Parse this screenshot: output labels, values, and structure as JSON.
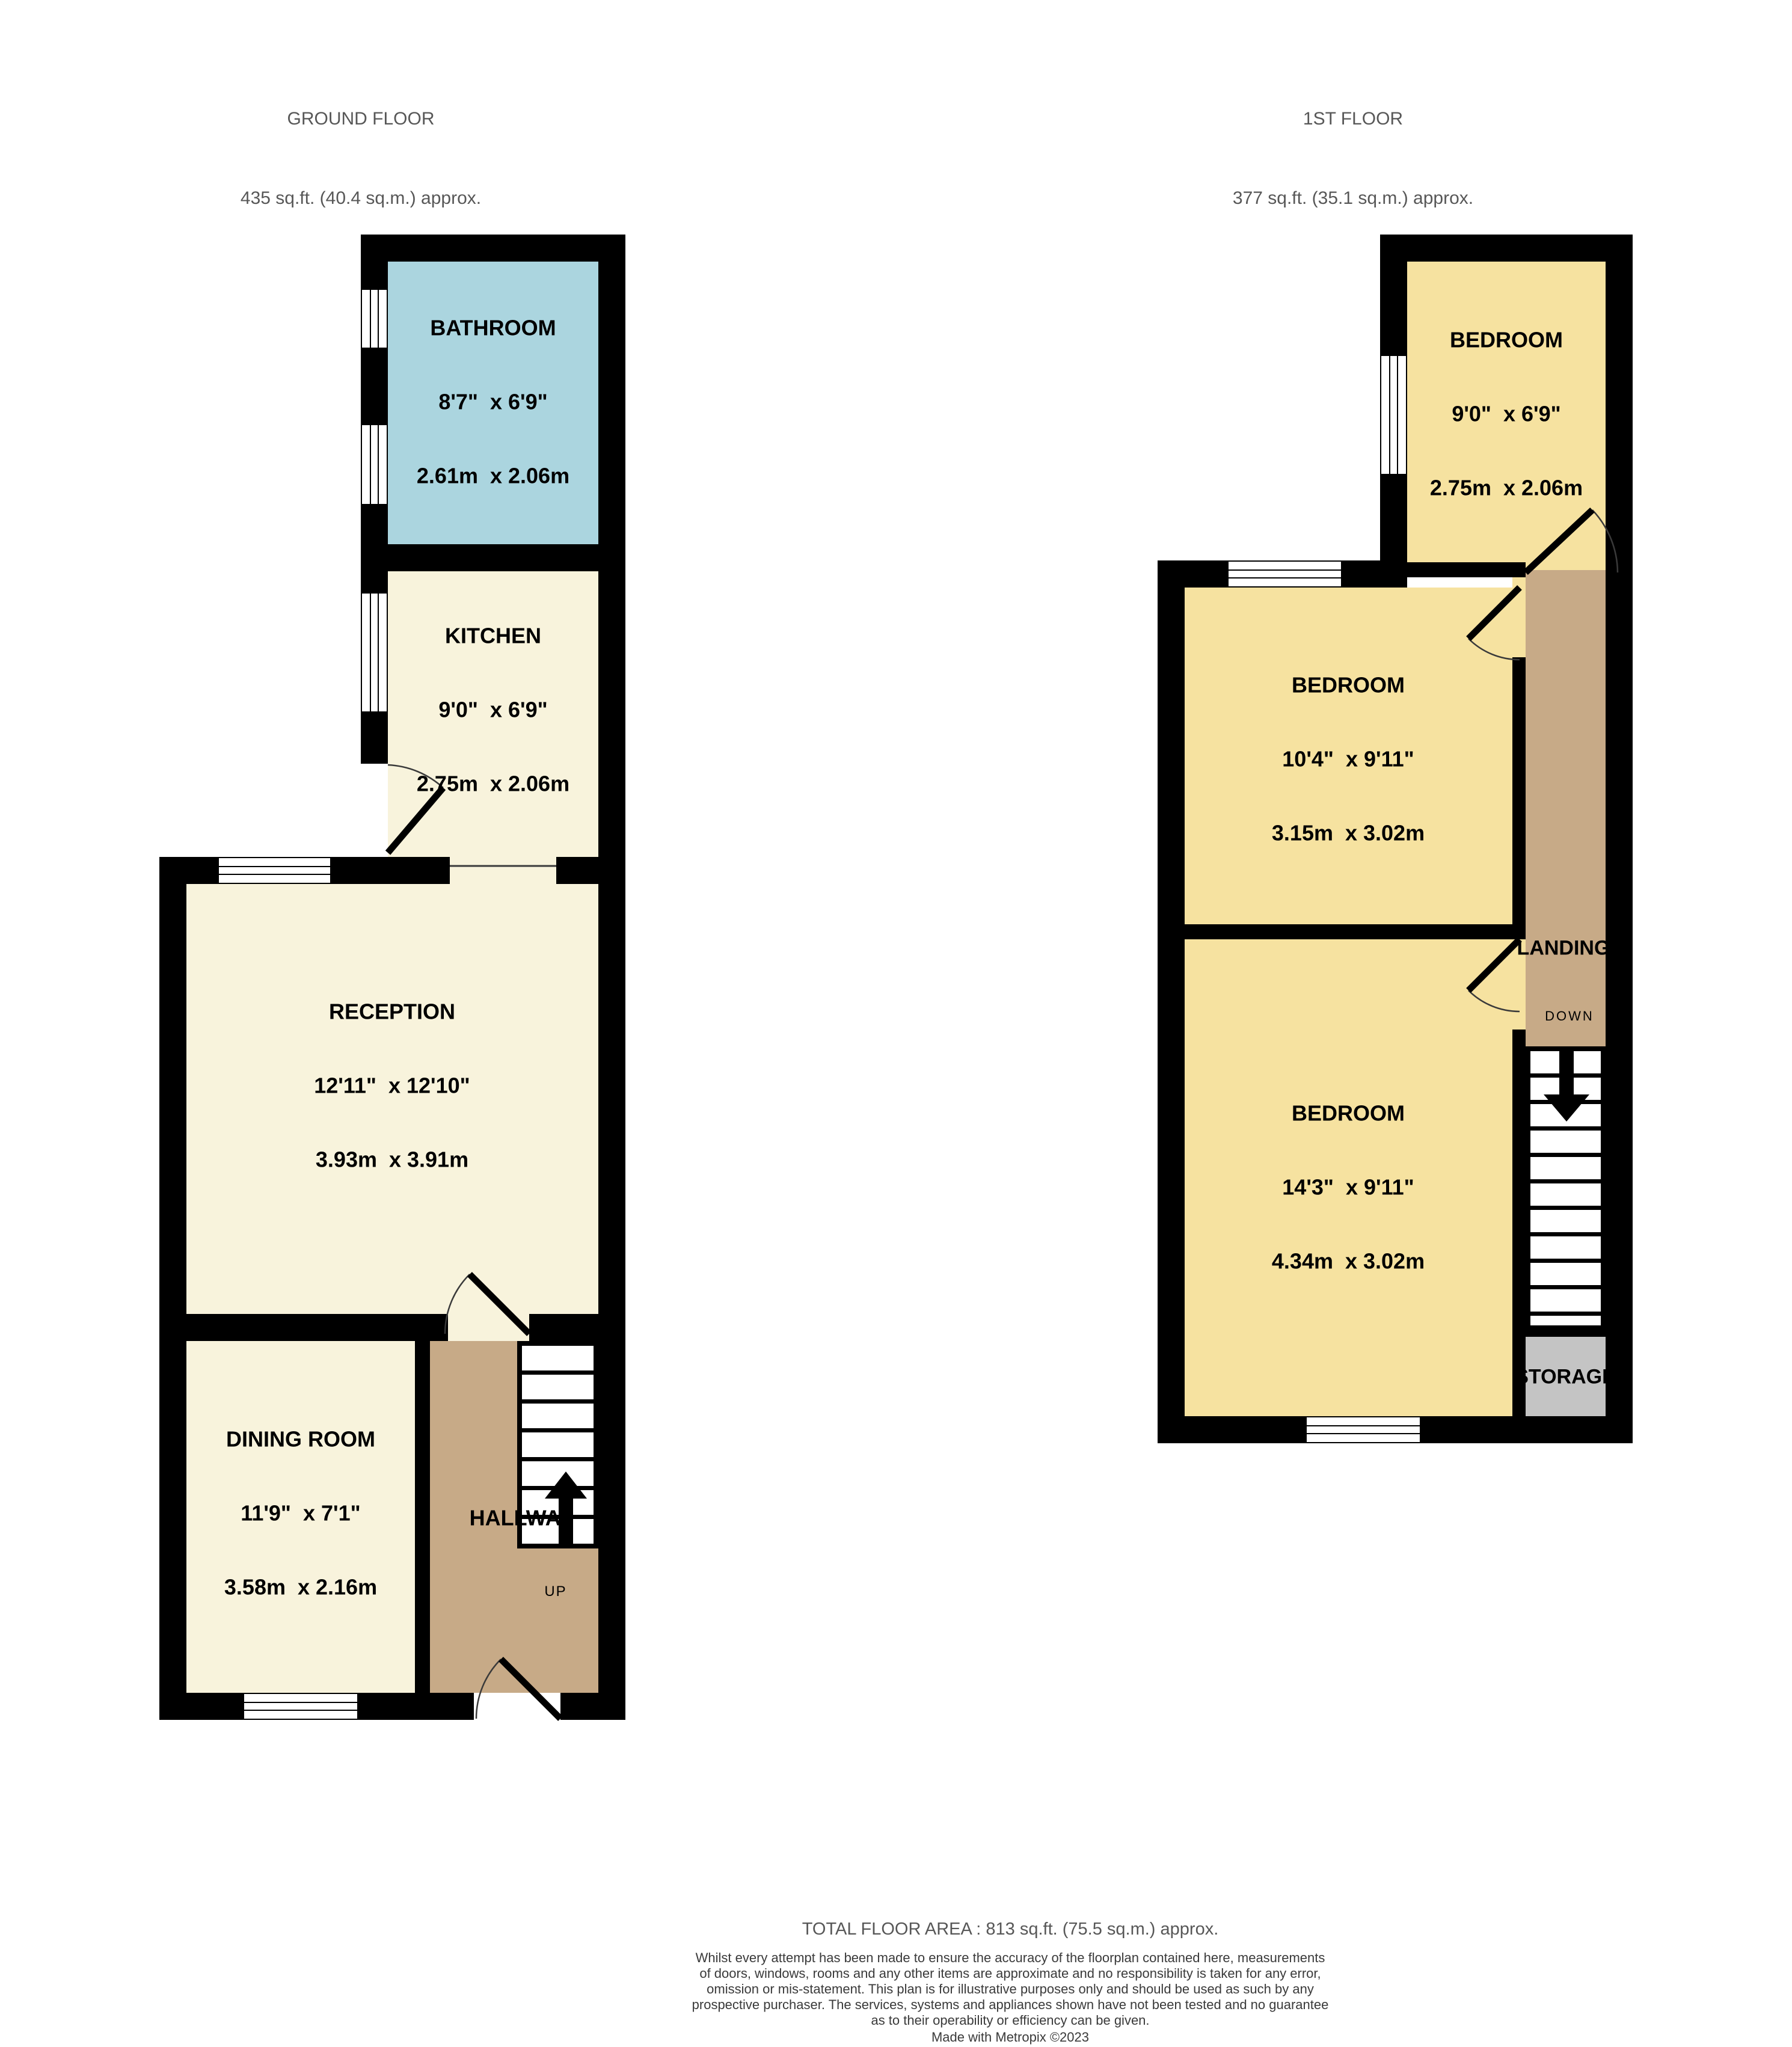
{
  "headers": {
    "ground": {
      "title": "GROUND FLOOR",
      "area": "435 sq.ft. (40.4 sq.m.) approx."
    },
    "first": {
      "title": "1ST FLOOR",
      "area": "377 sq.ft. (35.1 sq.m.) approx."
    }
  },
  "rooms": {
    "bathroom": {
      "name": "BATHROOM",
      "imperial": "8'7\"  x 6'9\"",
      "metric": "2.61m  x 2.06m"
    },
    "kitchen": {
      "name": "KITCHEN",
      "imperial": "9'0\"  x 6'9\"",
      "metric": "2.75m  x 2.06m"
    },
    "reception": {
      "name": "RECEPTION",
      "imperial": "12'11\"  x 12'10\"",
      "metric": "3.93m  x 3.91m"
    },
    "dining": {
      "name": "DINING ROOM",
      "imperial": "11'9\"  x 7'1\"",
      "metric": "3.58m  x 2.16m"
    },
    "hallway": {
      "name": "HALLWAY",
      "up": "UP"
    },
    "bedroom_top": {
      "name": "BEDROOM",
      "imperial": "9'0\"  x 6'9\"",
      "metric": "2.75m  x 2.06m"
    },
    "bedroom_middle": {
      "name": "BEDROOM",
      "imperial": "10'4\"  x 9'11\"",
      "metric": "3.15m  x 3.02m"
    },
    "bedroom_bottom": {
      "name": "BEDROOM",
      "imperial": "14'3\"  x 9'11\"",
      "metric": "4.34m  x 3.02m"
    },
    "landing": {
      "name": "LANDING",
      "down": "DOWN"
    },
    "storage": {
      "name": "STORAGE"
    }
  },
  "footer": {
    "total": "TOTAL FLOOR AREA : 813 sq.ft. (75.5 sq.m.) approx.",
    "disclaimer_lines": [
      "Whilst every attempt has been made to ensure the accuracy of the floorplan contained here, measurements",
      "of doors, windows, rooms and any other items are approximate and no responsibility is taken for any error,",
      "omission or mis-statement. This plan is for illustrative purposes only and should be used as such by any",
      "prospective purchaser. The services, systems and appliances shown have not been tested and no guarantee",
      "as to their operability or efficiency can be given."
    ],
    "credit": "Made with Metropix ©2023"
  },
  "colors": {
    "page": "#ffffff",
    "wall": "#000000",
    "cream": "#f8f3dc",
    "yellow": "#f6e2a0",
    "blue": "#abd5df",
    "tan": "#c7aa87",
    "gray": "#c4c4c4",
    "heading": "#575757",
    "disclaimer": "#3a3a3a"
  }
}
